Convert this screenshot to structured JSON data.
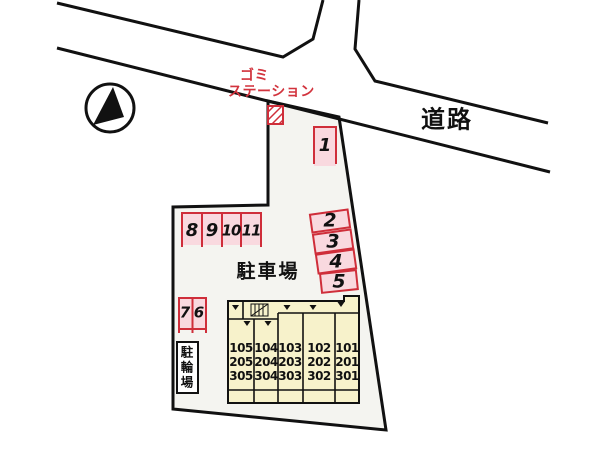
{
  "colors": {
    "stall_fill": "#f9d9df",
    "stall_border": "#cf2e3a",
    "label_red": "#d2333d",
    "building_fill": "#f7f2cb",
    "site_fill": "#f4f4f0",
    "line_black": "#111111"
  },
  "north_arrow": {
    "icon": "north-arrow-compass"
  },
  "road": {
    "label": "道路"
  },
  "garbage_station": {
    "line1": "ゴミ",
    "line2": "ステーション",
    "icon": "hatched-box"
  },
  "areas": {
    "parking_lot_label": "駐車場",
    "bicycle_parking_label": "駐\n輪\n場"
  },
  "parking_stalls": [
    {
      "label": "1"
    },
    {
      "label": "2"
    },
    {
      "label": "3"
    },
    {
      "label": "4"
    },
    {
      "label": "5"
    },
    {
      "label": "6"
    },
    {
      "label": "7"
    },
    {
      "label": "8"
    },
    {
      "label": "9"
    },
    {
      "label": "10"
    },
    {
      "label": "11"
    }
  ],
  "building": {
    "units": [
      {
        "label": "105\n205\n305"
      },
      {
        "label": "104\n204\n304"
      },
      {
        "label": "103\n203\n303"
      },
      {
        "label": "102\n202\n302"
      },
      {
        "label": "101\n201\n301"
      }
    ]
  }
}
